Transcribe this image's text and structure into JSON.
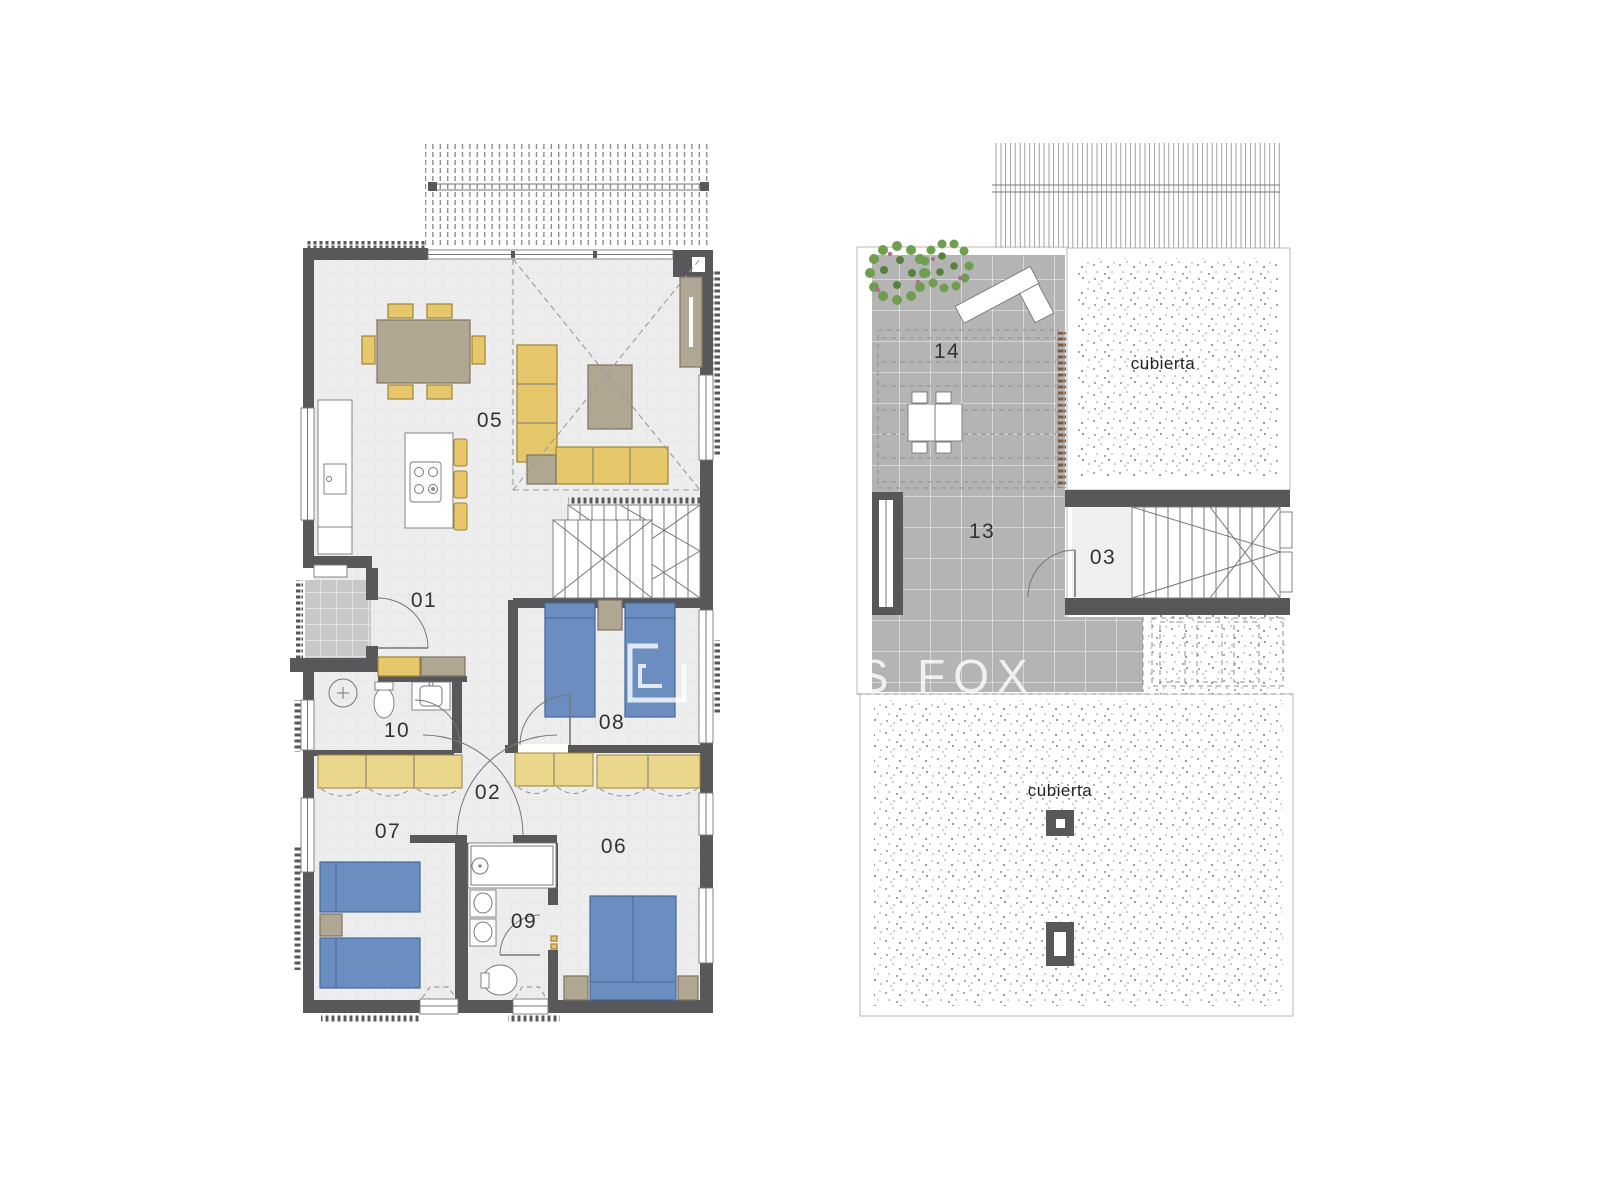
{
  "watermark": {
    "brand": "LUCAS FOX"
  },
  "plans": {
    "ground": {
      "rooms": [
        {
          "label": "01"
        },
        {
          "label": "02"
        },
        {
          "label": "05"
        },
        {
          "label": "06"
        },
        {
          "label": "07"
        },
        {
          "label": "08"
        },
        {
          "label": "09"
        },
        {
          "label": "10"
        }
      ]
    },
    "roof": {
      "rooms": [
        {
          "label": "03"
        },
        {
          "label": "13"
        },
        {
          "label": "14"
        }
      ],
      "cubierta": [
        "cubierta",
        "cubierta"
      ]
    }
  },
  "colors": {
    "wall": "#58585a",
    "floor": "#ededed",
    "floorGrid": "#e3e3e3",
    "porchTile": "#c8c8c8",
    "terrTile": "#b4b4b4",
    "tileGrid": "#f7f7f7",
    "furnYellow": "#e6c76c",
    "furnYellowBorder": "#9c8434",
    "robeYellow": "#ebd78b",
    "furnTan": "#b0a793",
    "furnTanBorder": "#7d7263",
    "bedBlue": "#6c8dbf",
    "bedBlueBorder": "#46679c",
    "plantGreen": "#6f9e4f",
    "plantGreenDark": "#55813a",
    "plantPink": "#b8679a",
    "stipple": "#8f8f8f",
    "line": "#777777",
    "dash": "#9a9a9a",
    "combBrown": "#7a5c42",
    "watermark": "#ffffff"
  }
}
